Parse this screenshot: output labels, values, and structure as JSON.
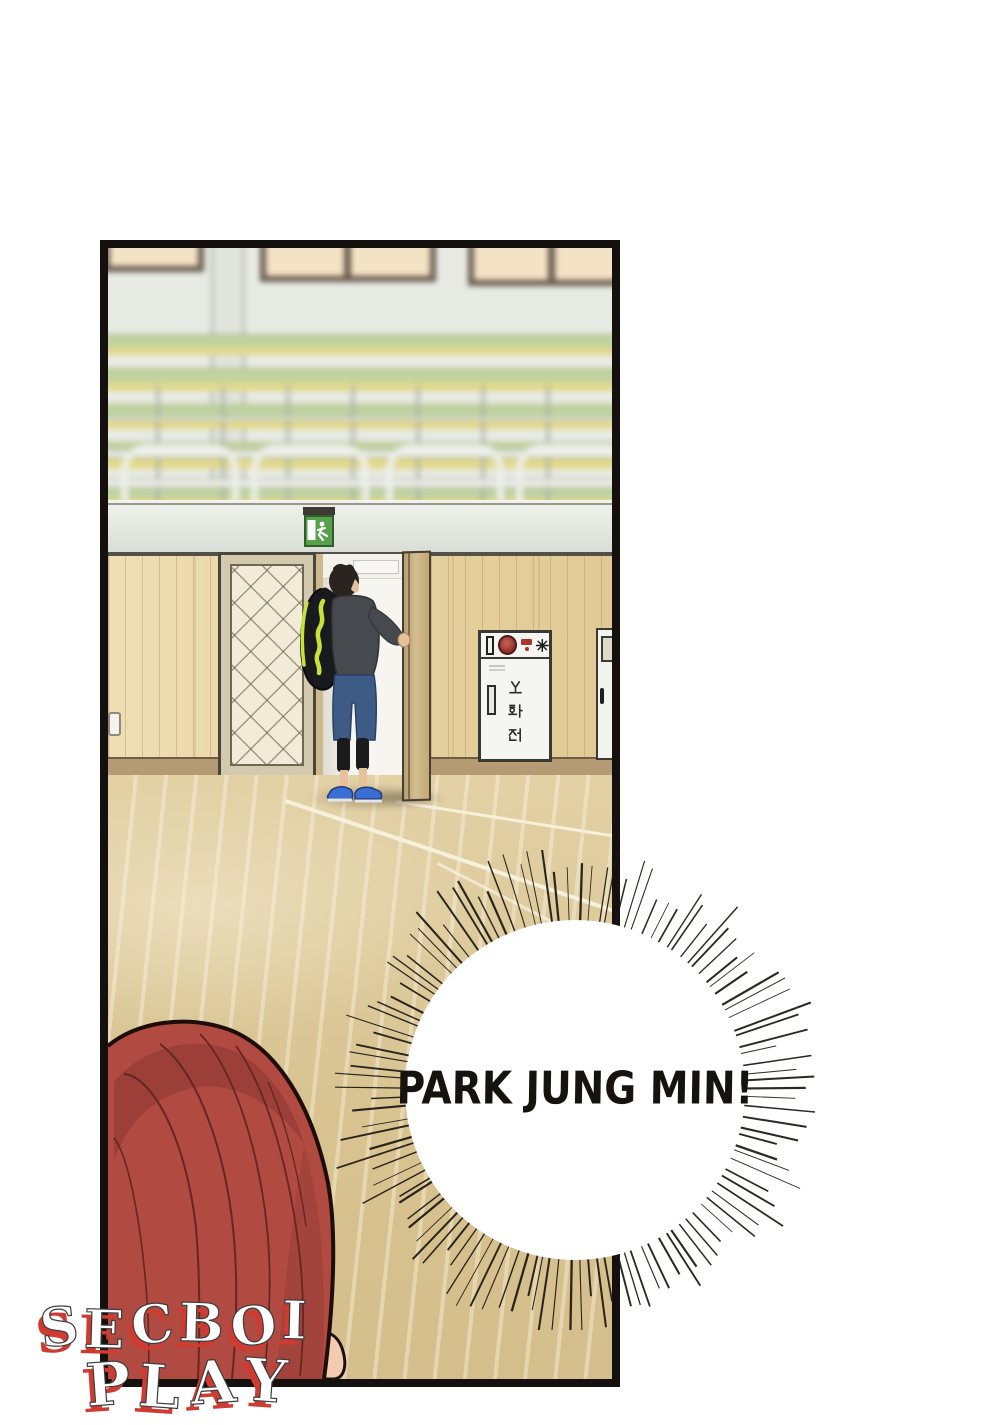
{
  "page": {
    "type": "webtoon-panel",
    "background": "#ffffff"
  },
  "panel": {
    "border_color": "#13100d"
  },
  "scene": {
    "exit_sign": {
      "icon": "running-man-icon",
      "color": "#57a14b"
    },
    "fire_cabinet": {
      "label": "소화전",
      "chars": [
        "소",
        "화",
        "전"
      ],
      "body_color": "#f5f5f1",
      "bell_color": "#a23331"
    },
    "colors": {
      "upper_wall": "#e7ebe4",
      "window_pane": "#f4e2c4",
      "bench_green": "#c0d3a0",
      "bench_yellow": "#e3d98b",
      "wall_wood": "#e9d6a6",
      "floor": "#dbc795"
    },
    "player": {
      "bag_accent": "#c9e23b",
      "jacket": "#46494d",
      "shorts": "#3e5b86",
      "shoes": "#3a6fd4"
    },
    "foreground_character": {
      "hair_color": "#b14a41"
    }
  },
  "bubble": {
    "shape": "burst",
    "text": "PARK JUNG MIN!",
    "text_color": "#16130f"
  },
  "watermark": {
    "line1": "SECBOI",
    "line2": "PLAY",
    "fill": "#ffffff",
    "shadow_color": "#cf3a31"
  }
}
